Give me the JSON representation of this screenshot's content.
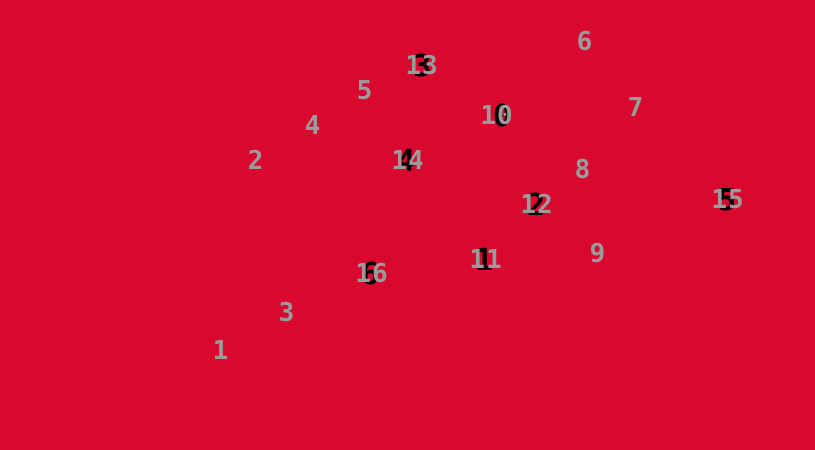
{
  "canvas": {
    "background_color": "#D8082F",
    "number_color": "#9B9B9B",
    "shadow_color": "#000000",
    "width": 815,
    "height": 450
  },
  "markers": [
    {
      "label": "1",
      "x": 221,
      "y": 351,
      "shadow": null
    },
    {
      "label": "2",
      "x": 256,
      "y": 161,
      "shadow": null
    },
    {
      "label": "3",
      "x": 287,
      "y": 313,
      "shadow": null
    },
    {
      "label": "4",
      "x": 313,
      "y": 126,
      "shadow": null
    },
    {
      "label": "5",
      "x": 365,
      "y": 91,
      "shadow": null
    },
    {
      "label": "6",
      "x": 585,
      "y": 42,
      "shadow": null
    },
    {
      "label": "7",
      "x": 636,
      "y": 108,
      "shadow": null
    },
    {
      "label": "8",
      "x": 583,
      "y": 170,
      "shadow": null
    },
    {
      "label": "9",
      "x": 598,
      "y": 254,
      "shadow": null
    },
    {
      "label": "10",
      "x": 497,
      "y": 116,
      "shadow": {
        "char": "0",
        "dx": 5,
        "dy": 1
      }
    },
    {
      "label": "11",
      "x": 486,
      "y": 260,
      "shadow": {
        "char": "1",
        "dx": -2,
        "dy": 1
      }
    },
    {
      "label": "12",
      "x": 537,
      "y": 205,
      "shadow": {
        "char": "2",
        "dx": -1,
        "dy": 1
      }
    },
    {
      "label": "13",
      "x": 422,
      "y": 66,
      "shadow": {
        "char": "3",
        "dx": 0,
        "dy": 1
      }
    },
    {
      "label": "14",
      "x": 408,
      "y": 161,
      "shadow": {
        "char": "4",
        "dx": -2,
        "dy": 1
      }
    },
    {
      "label": "15",
      "x": 728,
      "y": 200,
      "shadow": {
        "char": "5",
        "dx": -1,
        "dy": 1
      }
    },
    {
      "label": "16",
      "x": 372,
      "y": 274,
      "shadow": {
        "char": "6",
        "dx": -2,
        "dy": 1
      }
    }
  ]
}
